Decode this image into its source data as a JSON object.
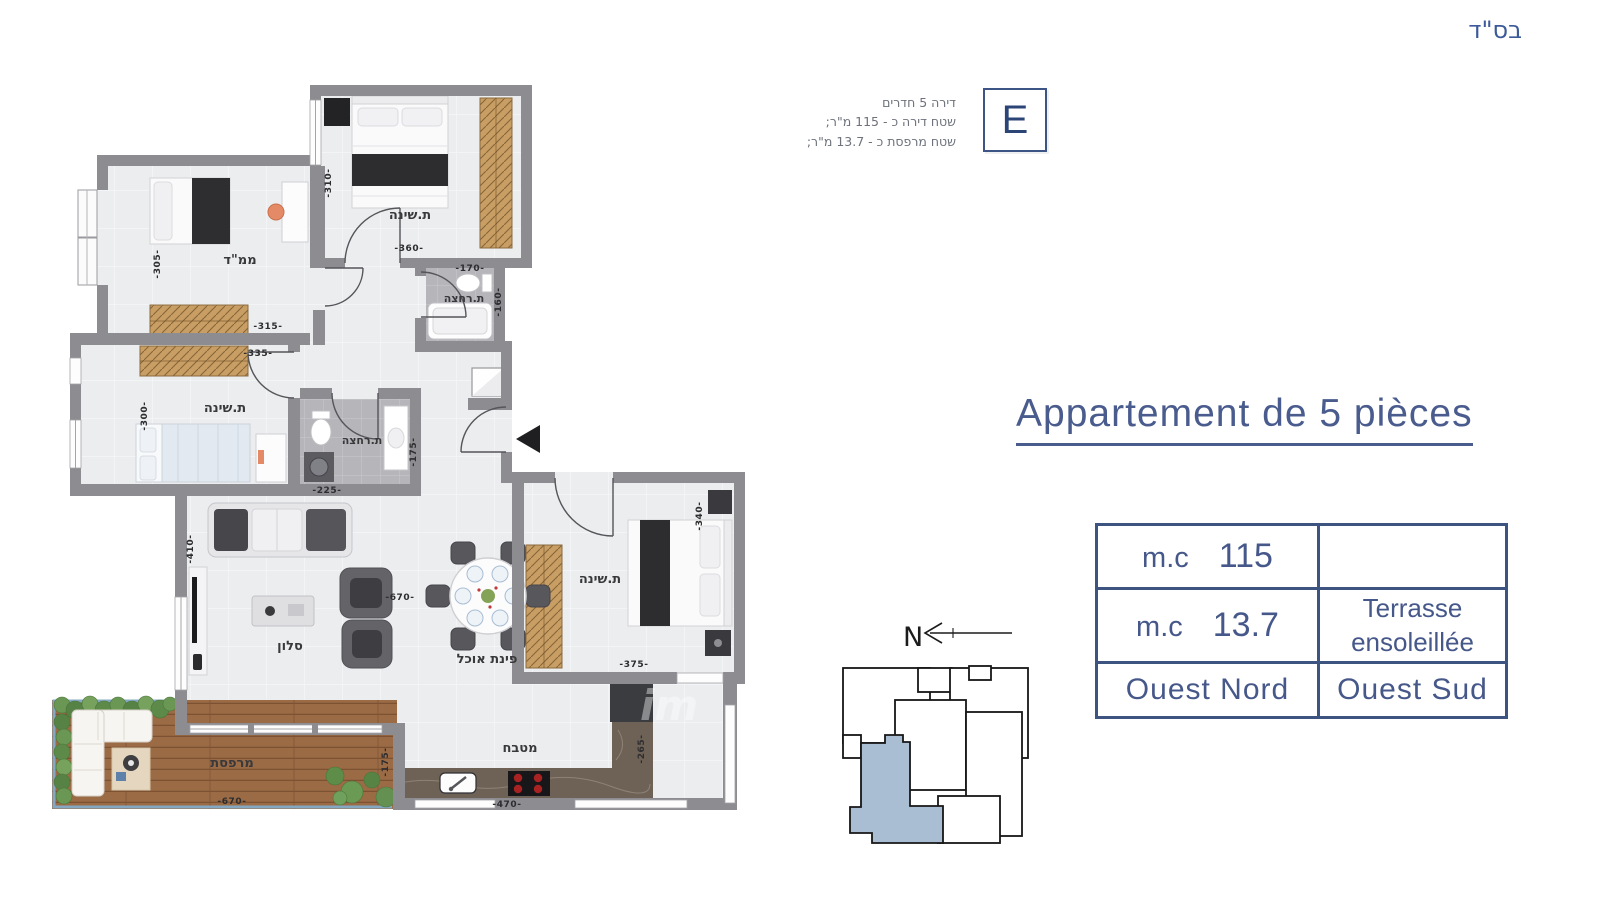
{
  "header": {
    "bsd": "בס\"ד"
  },
  "unit_badge": {
    "letter": "E",
    "line1": "דירה 5 חדרים",
    "line2": "שטח דירה כ - 115 מ\"ר;",
    "line3": "שטח מרפסת כ - 13.7 מ\"ר;"
  },
  "title": {
    "text": "Appartement de 5 pièces"
  },
  "spec_table": {
    "row1": {
      "unit": "m.c",
      "value": "115",
      "right": ""
    },
    "row2": {
      "unit": "m.c",
      "value": "13.7",
      "right_line1": "Terrasse",
      "right_line2": "ensoleillée"
    },
    "row3": {
      "left": "Ouest Nord",
      "right": "Ouest Sud"
    }
  },
  "compass": {
    "north": "N"
  },
  "watermark": "im",
  "floorplan": {
    "room_labels": {
      "bedroom1": "ת.שינה",
      "mamad": "ממ\"ד",
      "bath1": "ת.רחצה",
      "bedroom2": "ת.שינה",
      "bath2": "ת.רחצה",
      "salon": "סלון",
      "dining": "פינת אוכל",
      "bedroom3": "ת.שינה",
      "kitchen": "מטבח",
      "terrace": "מרפסת"
    },
    "dims": {
      "d310": "-310-",
      "d360": "-360-",
      "d305": "-305-",
      "d315": "-315-",
      "d335": "-335-",
      "d300": "-300-",
      "d170": "-170-",
      "d160": "-160-",
      "d225": "-225-",
      "d175a": "-175-",
      "d410": "-410-",
      "d670a": "-670-",
      "d340": "-340-",
      "d375": "-375-",
      "d265": "-265-",
      "d470": "-470-",
      "d670b": "-670-",
      "d175b": "-175-"
    }
  },
  "colors": {
    "accent": "#4a5c8e",
    "table_border": "#3e5480",
    "keyplan_highlight": "#a9bdd3",
    "wall": "#8d8d91"
  }
}
